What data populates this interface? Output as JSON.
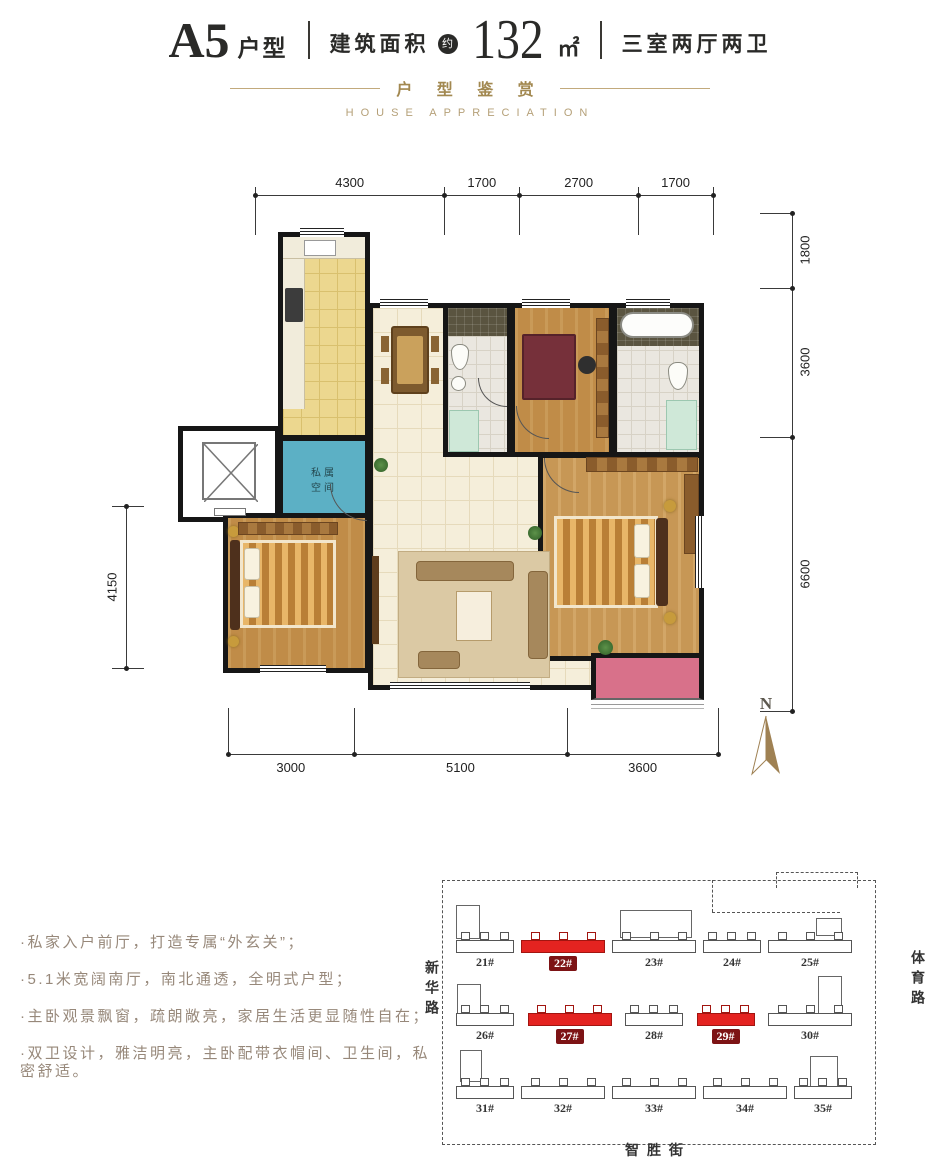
{
  "header": {
    "unit": "A5",
    "unit_suffix": "户型",
    "area_label": "建筑面积",
    "approx": "约",
    "area_value": "132",
    "area_unit": "㎡",
    "layout": "三室两厅两卫",
    "subtitle_cn": "户 型 鉴 赏",
    "subtitle_en": "HOUSE APPRECIATION"
  },
  "plan": {
    "dims_top": [
      "4300",
      "1700",
      "2700",
      "1700"
    ],
    "dims_right": [
      "1800",
      "3600",
      "6600"
    ],
    "dims_left": [
      "4150"
    ],
    "dims_bottom": [
      "3000",
      "5100",
      "3600"
    ],
    "foyer_label": [
      "私属",
      "空间"
    ],
    "north_label": "N"
  },
  "features": [
    "·私家入户前厅，打造专属“外玄关”；",
    "·5.1米宽阔南厅，南北通透，全明式户型；",
    "·主卧观景飘窗，疏朗敞亮，家居生活更显随性自在；",
    "·双卫设计，雅洁明亮，主卧配带衣帽间、卫生间，私密舒适。"
  ],
  "site_map": {
    "roads": {
      "left": "新华路",
      "right": "体育路",
      "bottom": "智胜街"
    },
    "rows": [
      {
        "buildings": [
          {
            "label": "21#"
          },
          {
            "label": "22#",
            "highlight": true,
            "wide": true
          },
          {
            "label": "23#",
            "wide": true
          },
          {
            "label": "24#"
          },
          {
            "label": "25#",
            "wide": true
          }
        ]
      },
      {
        "buildings": [
          {
            "label": "26#"
          },
          {
            "label": "27#",
            "highlight": true,
            "wide": true
          },
          {
            "label": "28#"
          },
          {
            "label": "29#",
            "highlight": true
          },
          {
            "label": "30#",
            "wide": true
          }
        ]
      },
      {
        "buildings": [
          {
            "label": "31#"
          },
          {
            "label": "32#",
            "wide": true
          },
          {
            "label": "33#",
            "wide": true
          },
          {
            "label": "34#",
            "wide": true
          },
          {
            "label": "35#"
          }
        ]
      }
    ]
  },
  "colors": {
    "accent_gold": "#a28850",
    "feature_text": "#97887a",
    "highlight_red": "#e42320",
    "badge_red": "#7d1315",
    "title_ink": "#2a2a28",
    "foyer_blue": "#5cb0c5",
    "balcony_pink": "#d8718a"
  }
}
